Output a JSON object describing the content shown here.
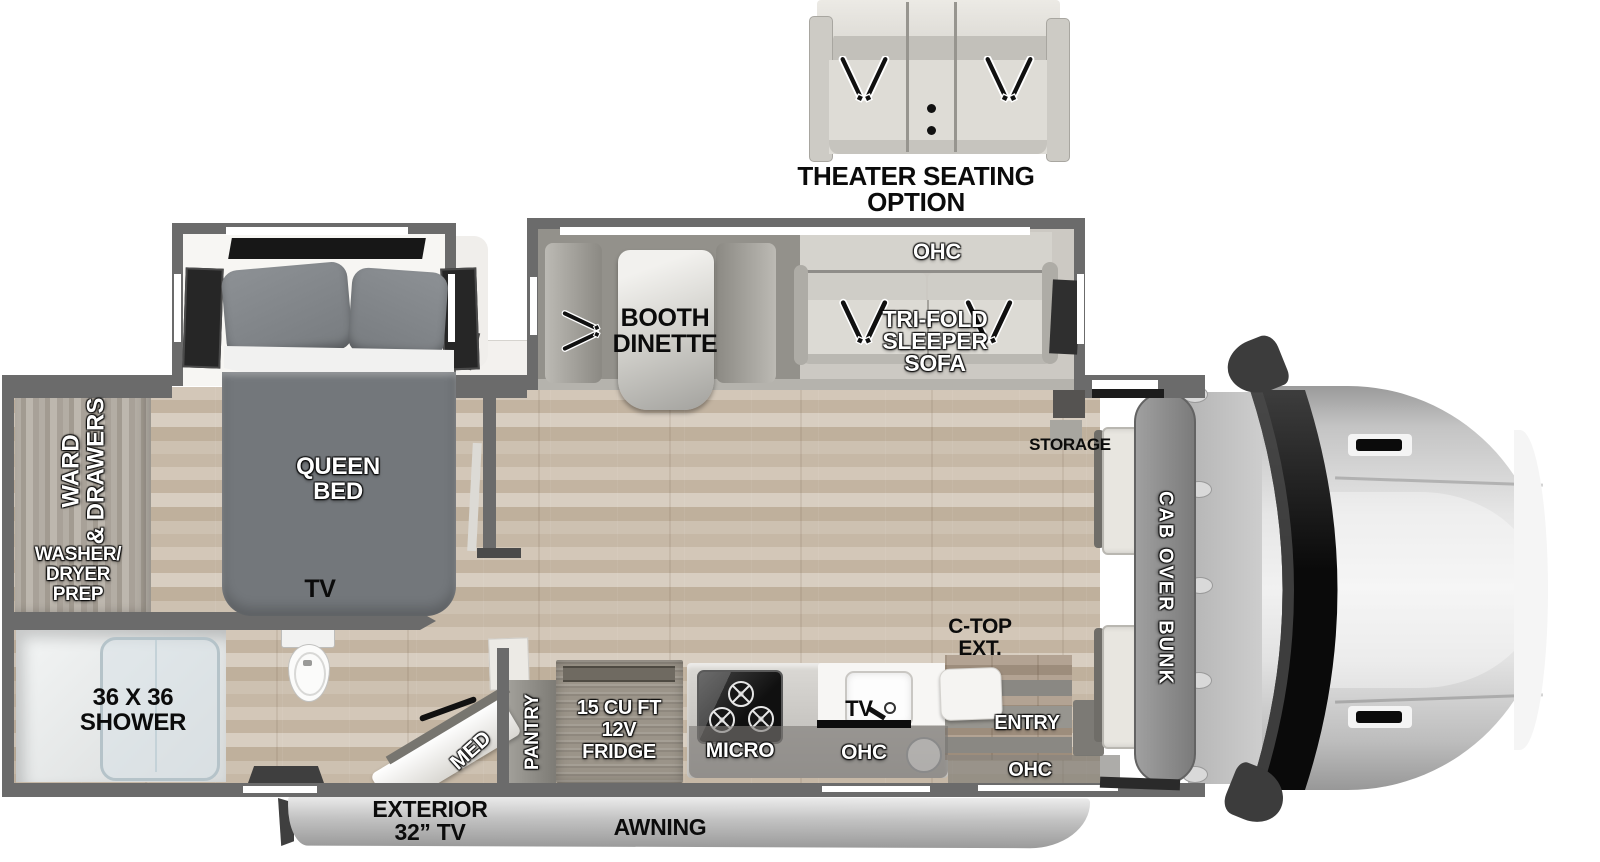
{
  "theater": {
    "label_lines": [
      "THEATER SEATING",
      "OPTION"
    ]
  },
  "rooms": {
    "bedroom": {
      "queen_bed_lines": [
        "QUEEN",
        "BED"
      ],
      "ward_lines": [
        "WARD",
        "& DRAWERS"
      ],
      "washer_lines": [
        "WASHER/",
        "DRYER",
        "PREP"
      ],
      "tv_label": "TV"
    },
    "bathroom": {
      "shower_lines": [
        "36 X 36",
        "SHOWER"
      ],
      "med_label": "MED"
    },
    "living": {
      "ohc_label": "OHC",
      "sofa_lines": [
        "TRI-FOLD",
        "SLEEPER",
        "SOFA"
      ],
      "dinette_lines": [
        "BOOTH",
        "DINETTE"
      ]
    },
    "kitchen": {
      "pantry_label": "PANTRY",
      "fridge_lines": [
        "15 CU FT",
        "12V",
        "FRIDGE"
      ],
      "micro_label": "MICRO",
      "tv_label": "TV",
      "ohc_label": "OHC",
      "ctop_lines": [
        "C-TOP",
        "EXT."
      ]
    },
    "entry": {
      "entry_label": "ENTRY",
      "ohc_label": "OHC"
    },
    "front": {
      "storage_label": "STORAGE",
      "bunk_label": "CAB OVER BUNK"
    },
    "exterior": {
      "tv_lines": [
        "EXTERIOR",
        "32” TV"
      ],
      "awning_label": "AWNING"
    }
  },
  "icons": {
    "seatbelt": "v-strap seatbelt",
    "burner": "stove burner ring",
    "toilet": "toilet top view",
    "sink": "kitchen sink",
    "mirror": "side mirror"
  },
  "colors": {
    "wall": "#6b6b6b",
    "floor_base": "#c9bcab",
    "bed_gray": "#73777b",
    "sofa_light": "#dcdad4",
    "windshield": "#0d0d0d"
  }
}
